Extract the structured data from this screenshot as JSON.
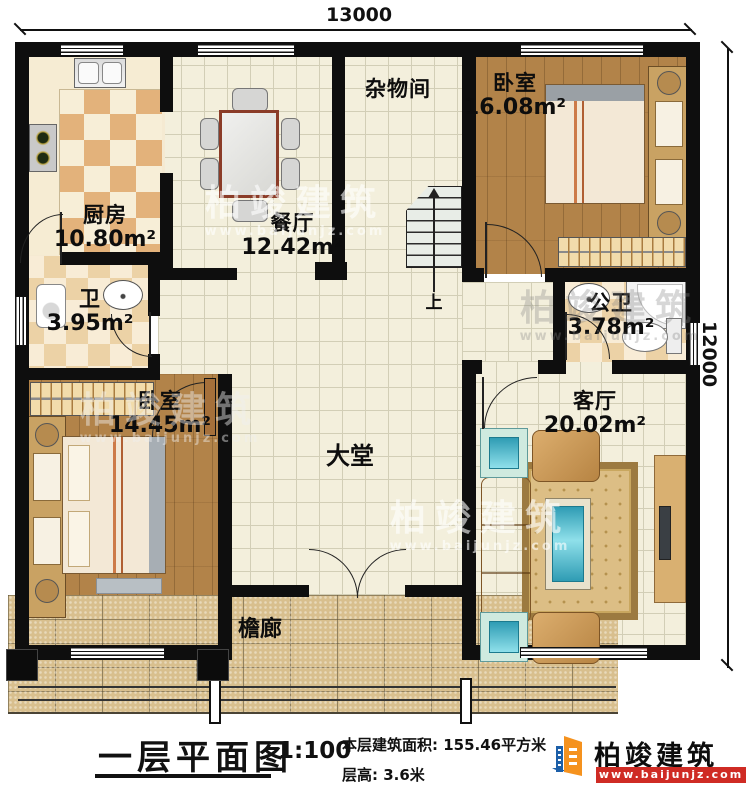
{
  "plan": {
    "dim_top": "13000",
    "dim_right": "12000",
    "up_label": "上",
    "rooms": {
      "kitchen": {
        "name": "厨房",
        "area": "10.80m²"
      },
      "dining": {
        "name": "餐厅",
        "area": "12.42m²"
      },
      "storage": {
        "name": "杂物间"
      },
      "bedroom_top": {
        "name": "卧室",
        "area": "16.08m²"
      },
      "bath": {
        "name": "卫",
        "area": "3.95m²"
      },
      "public_bath": {
        "name": "公卫",
        "area": "3.78m²"
      },
      "living": {
        "name": "客厅",
        "area": "20.02m²"
      },
      "bedroom_left": {
        "name": "卧室",
        "area": "14.45m²"
      },
      "hall": {
        "name": "大堂"
      },
      "porch": {
        "name": "檐廊"
      }
    }
  },
  "footer": {
    "title": "一层平面图",
    "scale": "1:100",
    "area_label": "本层建筑面积:",
    "area_value": "155.46平方米",
    "floor_height_label": "层高:",
    "floor_height_value": "3.6米"
  },
  "brand": {
    "name": "柏竣建筑",
    "url": "www.baijunjz.com",
    "blue": "#1c5fa8",
    "orange": "#f5921e",
    "red": "#cf2b24"
  },
  "watermark": {
    "name": "柏竣建筑",
    "url": "www.baijunjz.com"
  }
}
